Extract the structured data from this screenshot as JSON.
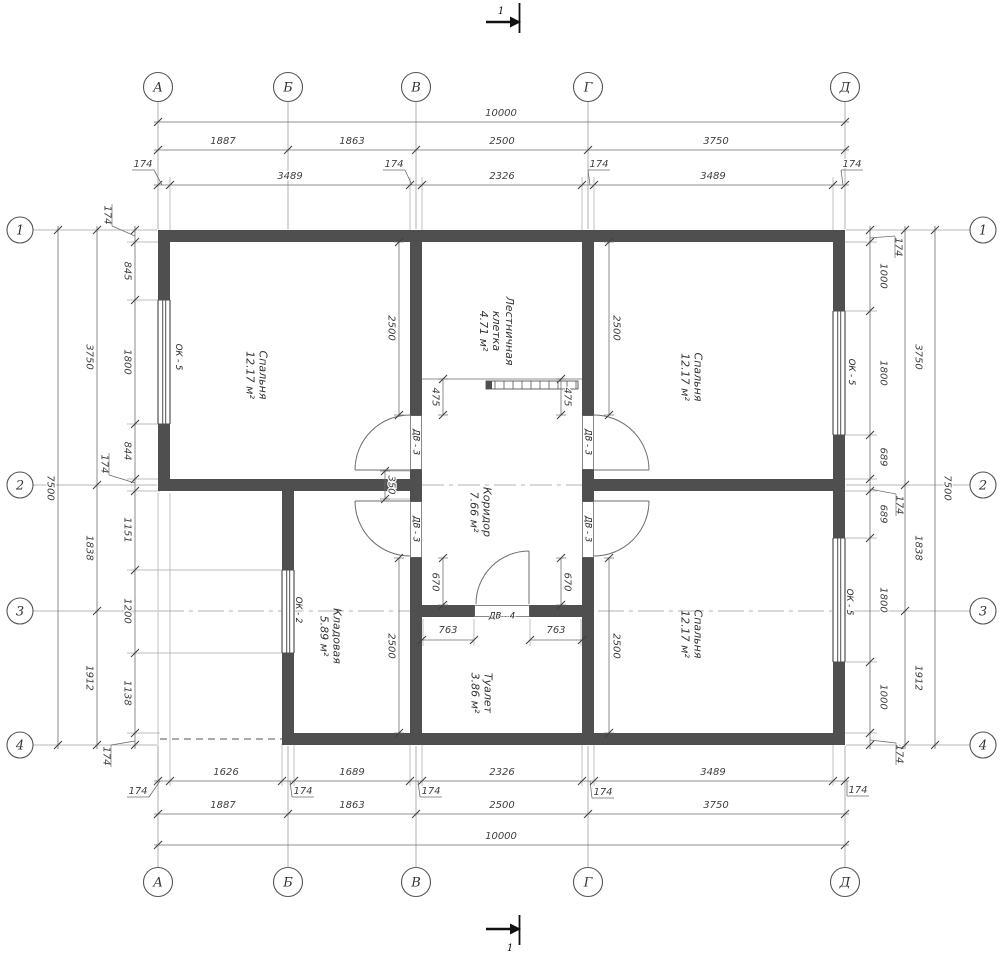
{
  "colors": {
    "wall": "#4f4f4f",
    "line": "#6e6e6e",
    "dim_text": "#3f3f3f",
    "axis_line": "#9f9f9f",
    "tick": "#3f3f3f"
  },
  "section_mark": {
    "label": "1"
  },
  "axes": {
    "letters": [
      {
        "ch": "А",
        "x": 158
      },
      {
        "ch": "Б",
        "x": 288
      },
      {
        "ch": "В",
        "x": 416
      },
      {
        "ch": "Г",
        "x": 588
      },
      {
        "ch": "Д",
        "x": 845
      }
    ],
    "numbers": [
      {
        "ch": "1",
        "y": 230
      },
      {
        "ch": "2",
        "y": 485
      },
      {
        "ch": "3",
        "y": 611
      },
      {
        "ch": "4",
        "y": 745
      }
    ],
    "top_cy": 87,
    "bottom_cy": 882,
    "left_cx": 20,
    "right_cx": 983,
    "r_tb": 14.5,
    "r_lr": 13
  },
  "dimensions": {
    "h_chains": [
      {
        "y": 122,
        "x1": 154,
        "x2": 849,
        "ticks": [
          158,
          845
        ],
        "labels": [
          {
            "t": "10000",
            "x": 501,
            "y": 116
          }
        ]
      },
      {
        "y": 150,
        "x1": 154,
        "x2": 849,
        "ticks": [
          158,
          288,
          416,
          588,
          845
        ],
        "labels": [
          {
            "t": "1887",
            "x": 223,
            "y": 144
          },
          {
            "t": "1863",
            "x": 352,
            "y": 144
          },
          {
            "t": "2500",
            "x": 502,
            "y": 144
          },
          {
            "t": "3750",
            "x": 716,
            "y": 144
          }
        ]
      },
      {
        "y": 185,
        "x1": 154,
        "x2": 849,
        "ticks": [
          158,
          170,
          410,
          422,
          582,
          594,
          833,
          845
        ],
        "labels": [
          {
            "t": "3489",
            "x": 290,
            "y": 179
          },
          {
            "t": "2326",
            "x": 502,
            "y": 179
          },
          {
            "t": "3489",
            "x": 713,
            "y": 179
          }
        ],
        "offsets": [
          {
            "t": "174",
            "x": 143,
            "y": 167,
            "tx": 162
          },
          {
            "t": "174",
            "x": 394,
            "y": 167,
            "tx": 412
          },
          {
            "t": "174",
            "x": 599,
            "y": 167,
            "tx": 590
          },
          {
            "t": "174",
            "x": 852,
            "y": 167,
            "tx": 843
          }
        ]
      },
      {
        "y": 781,
        "x1": 154,
        "x2": 849,
        "ticks": [
          158,
          170,
          282,
          294,
          410,
          422,
          582,
          594,
          833,
          845
        ],
        "labels": [
          {
            "t": "1626",
            "x": 226,
            "y": 775
          },
          {
            "t": "1689",
            "x": 352,
            "y": 775
          },
          {
            "t": "2326",
            "x": 502,
            "y": 775
          },
          {
            "t": "3489",
            "x": 713,
            "y": 775
          }
        ],
        "offsets": [
          {
            "t": "174",
            "x": 138,
            "y": 794,
            "tx": 160
          },
          {
            "t": "174",
            "x": 303,
            "y": 794,
            "tx": 290
          },
          {
            "t": "174",
            "x": 431,
            "y": 794,
            "tx": 418
          },
          {
            "t": "174",
            "x": 603,
            "y": 795,
            "tx": 590
          },
          {
            "t": "174",
            "x": 858,
            "y": 793,
            "tx": 847
          }
        ]
      },
      {
        "y": 814,
        "x1": 154,
        "x2": 849,
        "ticks": [
          158,
          288,
          416,
          588,
          845
        ],
        "labels": [
          {
            "t": "1887",
            "x": 223,
            "y": 808
          },
          {
            "t": "1863",
            "x": 352,
            "y": 808
          },
          {
            "t": "2500",
            "x": 502,
            "y": 808
          },
          {
            "t": "3750",
            "x": 716,
            "y": 808
          }
        ]
      },
      {
        "y": 845,
        "x1": 154,
        "x2": 849,
        "ticks": [
          158,
          845
        ],
        "labels": [
          {
            "t": "10000",
            "x": 501,
            "y": 839
          }
        ]
      }
    ],
    "v_chains": [
      {
        "x": 58,
        "y1": 226,
        "y2": 749,
        "ticks": [
          230,
          745
        ],
        "labels": [
          {
            "t": "7500",
            "x": 51,
            "y": 488
          }
        ]
      },
      {
        "x": 97,
        "y1": 226,
        "y2": 749,
        "ticks": [
          230,
          485,
          611,
          745
        ],
        "labels": [
          {
            "t": "3750",
            "x": 90,
            "y": 357
          },
          {
            "t": "1838",
            "x": 90,
            "y": 548
          },
          {
            "t": "1912",
            "x": 90,
            "y": 678
          }
        ]
      },
      {
        "x": 135,
        "y1": 226,
        "y2": 749,
        "ticks": [
          230,
          242,
          300,
          424,
          479,
          491,
          570,
          653,
          733,
          745
        ],
        "labels": [
          {
            "t": "845",
            "x": 128,
            "y": 271
          },
          {
            "t": "1800",
            "x": 128,
            "y": 362
          },
          {
            "t": "844",
            "x": 128,
            "y": 451
          },
          {
            "t": "1151",
            "x": 128,
            "y": 530
          },
          {
            "t": "1200",
            "x": 128,
            "y": 611
          },
          {
            "t": "1138",
            "x": 128,
            "y": 693
          }
        ],
        "offsets": [
          {
            "t": "174",
            "x": 108,
            "y": 215,
            "ty": 236
          },
          {
            "t": "174",
            "x": 105,
            "y": 464,
            "ty": 483
          },
          {
            "t": "174",
            "x": 107,
            "y": 756,
            "ty": 741
          }
        ]
      },
      {
        "x": 870,
        "y1": 226,
        "y2": 749,
        "ticks": [
          230,
          242,
          311,
          435,
          479,
          491,
          538,
          662,
          733,
          745
        ],
        "labels": [
          {
            "t": "1000",
            "x": 884,
            "y": 276
          },
          {
            "t": "1800",
            "x": 884,
            "y": 373
          },
          {
            "t": "689",
            "x": 884,
            "y": 457
          },
          {
            "t": "689",
            "x": 884,
            "y": 514
          },
          {
            "t": "1800",
            "x": 884,
            "y": 600
          },
          {
            "t": "1000",
            "x": 884,
            "y": 697
          }
        ],
        "offsets": [
          {
            "t": "174",
            "x": 899,
            "y": 247,
            "ty": 238
          },
          {
            "t": "174",
            "x": 900,
            "y": 505,
            "ty": 489
          },
          {
            "t": "174",
            "x": 900,
            "y": 754,
            "ty": 740
          }
        ]
      },
      {
        "x": 905,
        "y1": 226,
        "y2": 749,
        "ticks": [
          230,
          485,
          611,
          745
        ],
        "labels": [
          {
            "t": "3750",
            "x": 919,
            "y": 357
          },
          {
            "t": "1838",
            "x": 919,
            "y": 548
          },
          {
            "t": "1912",
            "x": 919,
            "y": 678
          }
        ]
      },
      {
        "x": 935,
        "y1": 226,
        "y2": 749,
        "ticks": [
          230,
          745
        ],
        "labels": [
          {
            "t": "7500",
            "x": 948,
            "y": 488
          }
        ]
      }
    ],
    "interior_v": [
      {
        "t": "2500",
        "x": 399,
        "y1": 242,
        "y2": 415,
        "lx": 392,
        "ly": 328
      },
      {
        "t": "2500",
        "x": 609,
        "y1": 242,
        "y2": 415,
        "lx": 617,
        "ly": 328
      },
      {
        "t": "2500",
        "x": 399,
        "y1": 558,
        "y2": 733,
        "lx": 392,
        "ly": 646
      },
      {
        "t": "2500",
        "x": 609,
        "y1": 558,
        "y2": 733,
        "lx": 617,
        "ly": 646
      },
      {
        "t": "475",
        "x": 443,
        "y1": 379,
        "y2": 415,
        "lx": 436,
        "ly": 397
      },
      {
        "t": "475",
        "x": 561,
        "y1": 379,
        "y2": 415,
        "lx": 568,
        "ly": 397
      },
      {
        "t": "350",
        "x": 385,
        "y1": 471,
        "y2": 499,
        "lx": 392,
        "ly": 485
      },
      {
        "t": "670",
        "x": 443,
        "y1": 558,
        "y2": 605,
        "lx": 436,
        "ly": 582
      },
      {
        "t": "670",
        "x": 561,
        "y1": 558,
        "y2": 605,
        "lx": 568,
        "ly": 582
      }
    ],
    "interior_h": [
      {
        "t": "763",
        "y": 640,
        "x1": 422,
        "x2": 474,
        "lx": 448,
        "ly": 633
      },
      {
        "t": "763",
        "y": 640,
        "x1": 530,
        "x2": 582,
        "lx": 556,
        "ly": 633
      }
    ]
  },
  "rooms": [
    {
      "id": "bedroom-top-left",
      "lines": [
        "Спальня",
        "12.17 м²"
      ],
      "cx": 257,
      "cy": 375
    },
    {
      "id": "bedroom-top-right",
      "lines": [
        "Спальня",
        "12.17 м²"
      ],
      "cx": 692,
      "cy": 377
    },
    {
      "id": "bedroom-bottom-right",
      "lines": [
        "Спальня",
        "12.17 м²"
      ],
      "cx": 692,
      "cy": 634
    },
    {
      "id": "stairwell",
      "lines": [
        "Лестничная",
        "клетка",
        "4.71 м²"
      ],
      "cx": 497,
      "cy": 331
    },
    {
      "id": "corridor",
      "lines": [
        "Коридор",
        "7.66 м²"
      ],
      "cx": 481,
      "cy": 512
    },
    {
      "id": "storage",
      "lines": [
        "Кладовая",
        "5.89 м²"
      ],
      "cx": 331,
      "cy": 636
    },
    {
      "id": "toilet",
      "lines": [
        "Туалет",
        "3.86 м²"
      ],
      "cx": 482,
      "cy": 693
    }
  ],
  "tags": [
    {
      "id": "window-tag-ok5-left",
      "t": "ОК - 5",
      "x": 179,
      "y": 357,
      "rot": 90
    },
    {
      "id": "window-tag-ok5-right-top",
      "t": "ОК - 5",
      "x": 852,
      "y": 372,
      "rot": 90
    },
    {
      "id": "window-tag-ok5-right-bottom",
      "t": "ОК - 5",
      "x": 850,
      "y": 602,
      "rot": 90
    },
    {
      "id": "window-tag-ok2",
      "t": "ОК - 2",
      "x": 299,
      "y": 610,
      "rot": 90
    },
    {
      "id": "door-tag-dv3-v-top",
      "t": "ДВ - 3",
      "x": 416.5,
      "y": 442,
      "rot": 90
    },
    {
      "id": "door-tag-dv3-v-bottom",
      "t": "ДВ - 3",
      "x": 416.5,
      "y": 529,
      "rot": 90
    },
    {
      "id": "door-tag-dv3-g-top",
      "t": "ДВ - 3",
      "x": 588.5,
      "y": 442,
      "rot": 90
    },
    {
      "id": "door-tag-dv3-g-bottom",
      "t": "ДВ - 3",
      "x": 588.5,
      "y": 529,
      "rot": 90
    },
    {
      "id": "door-tag-dv4",
      "t": "ДВ - 4",
      "x": 502,
      "y": 611,
      "rot": 0
    }
  ]
}
